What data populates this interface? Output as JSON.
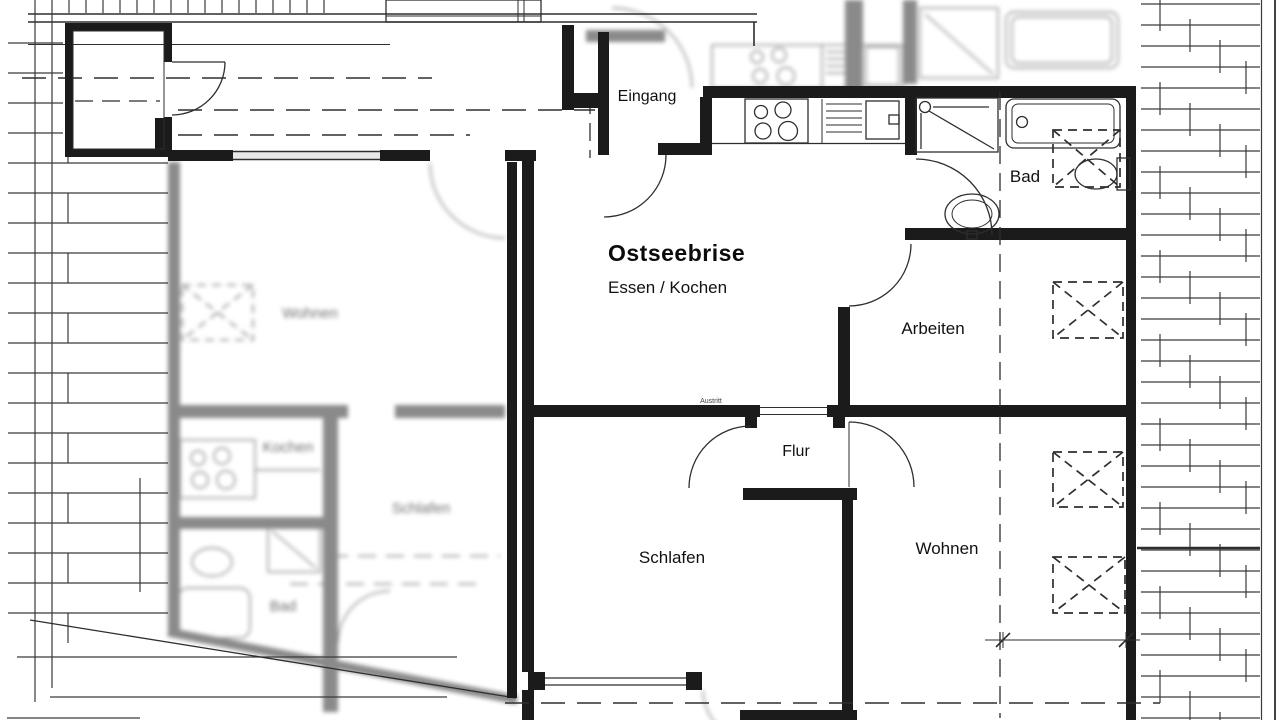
{
  "plan": {
    "title": "Ostseebrise",
    "subtitle": "Essen / Kochen",
    "rooms": {
      "eingang": "Eingang",
      "bad": "Bad",
      "arbeiten": "Arbeiten",
      "flur": "Flur",
      "schlafen": "Schlafen",
      "wohnen": "Wohnen",
      "austritt": "Austritt"
    },
    "neighbor_rooms": {
      "wohnen": "Wohnen",
      "kochen": "Kochen",
      "schlafen": "Schlafen",
      "bad": "Bad"
    },
    "icons": {
      "stove": "stove-burners-icon",
      "sink": "kitchen-sink-icon",
      "shower": "shower-icon",
      "bathtub": "bathtub-icon",
      "toilet": "toilet-icon",
      "washbasin": "washbasin-icon",
      "skylight": "skylight-dashed-box-icon",
      "door": "door-swing-icon"
    },
    "colors": {
      "wall": "#1b1b1b",
      "line": "#2e2e2e",
      "blur": "#8a8a8a",
      "background": "#ffffff",
      "window_fill": "#e8e8e8"
    }
  }
}
